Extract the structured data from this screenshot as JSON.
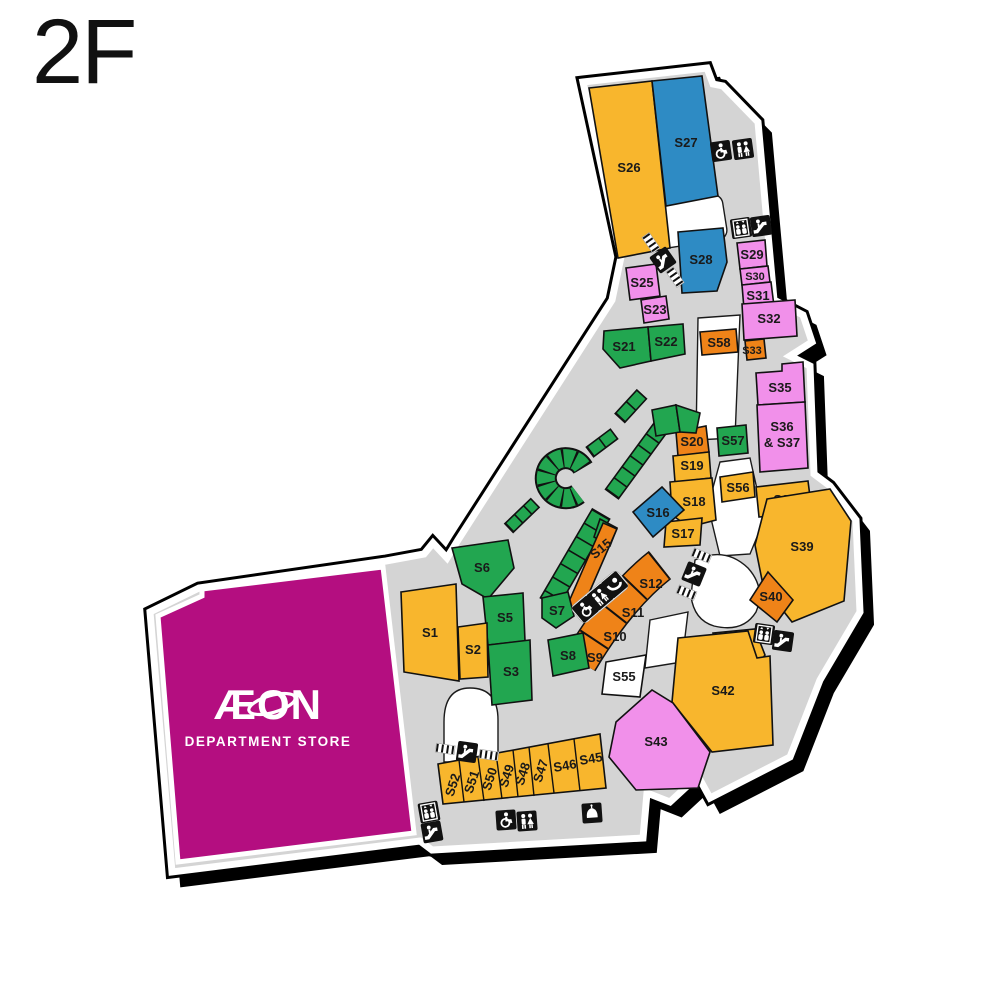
{
  "floor_label": "2F",
  "anchor_store": {
    "name": "ÆON",
    "subtitle": "DEPARTMENT STORE"
  },
  "stores": {
    "s1": "S1",
    "s2": "S2",
    "s3": "S3",
    "s5": "S5",
    "s6": "S6",
    "s7": "S7",
    "s8": "S8",
    "s9": "S9",
    "s10": "S10",
    "s11": "S11",
    "s12": "S12",
    "s15": "S15",
    "s16": "S16",
    "s17": "S17",
    "s18": "S18",
    "s19": "S19",
    "s20": "S20",
    "s21": "S21",
    "s22": "S22",
    "s23": "S23",
    "s25": "S25",
    "s26": "S26",
    "s27": "S27",
    "s28": "S28",
    "s29": "S29",
    "s30": "S30",
    "s31": "S31",
    "s32": "S32",
    "s33": "S33",
    "s35": "S35",
    "s36_37a": "S36",
    "s36_37b": "& S37",
    "s38": "S38",
    "s39": "S39",
    "s40": "S40",
    "s41": "S41",
    "s42": "S42",
    "s43": "S43",
    "s45": "S45",
    "s46": "S46",
    "s47": "S47",
    "s48": "S48",
    "s49": "S49",
    "s50": "S50",
    "s51": "S51",
    "s52": "S52",
    "s55": "S55",
    "s56": "S56",
    "s57": "S57",
    "s58": "S58"
  },
  "colors": {
    "store_yellow": "#F8B62D",
    "store_orange": "#EF8318",
    "store_blue": "#2E8BC4",
    "store_green": "#22A650",
    "store_pink": "#F190EA",
    "aeon_magenta": "#B40E80",
    "floor_gray": "#D4D4D4",
    "outline_black": "#000000",
    "void_white": "#FFFFFF"
  },
  "icons": {
    "restroom": "restroom",
    "accessible_restroom": "accessible restroom",
    "elevator": "elevator",
    "escalator": "escalator",
    "baby_room": "baby room",
    "prayer_room": "prayer room"
  }
}
